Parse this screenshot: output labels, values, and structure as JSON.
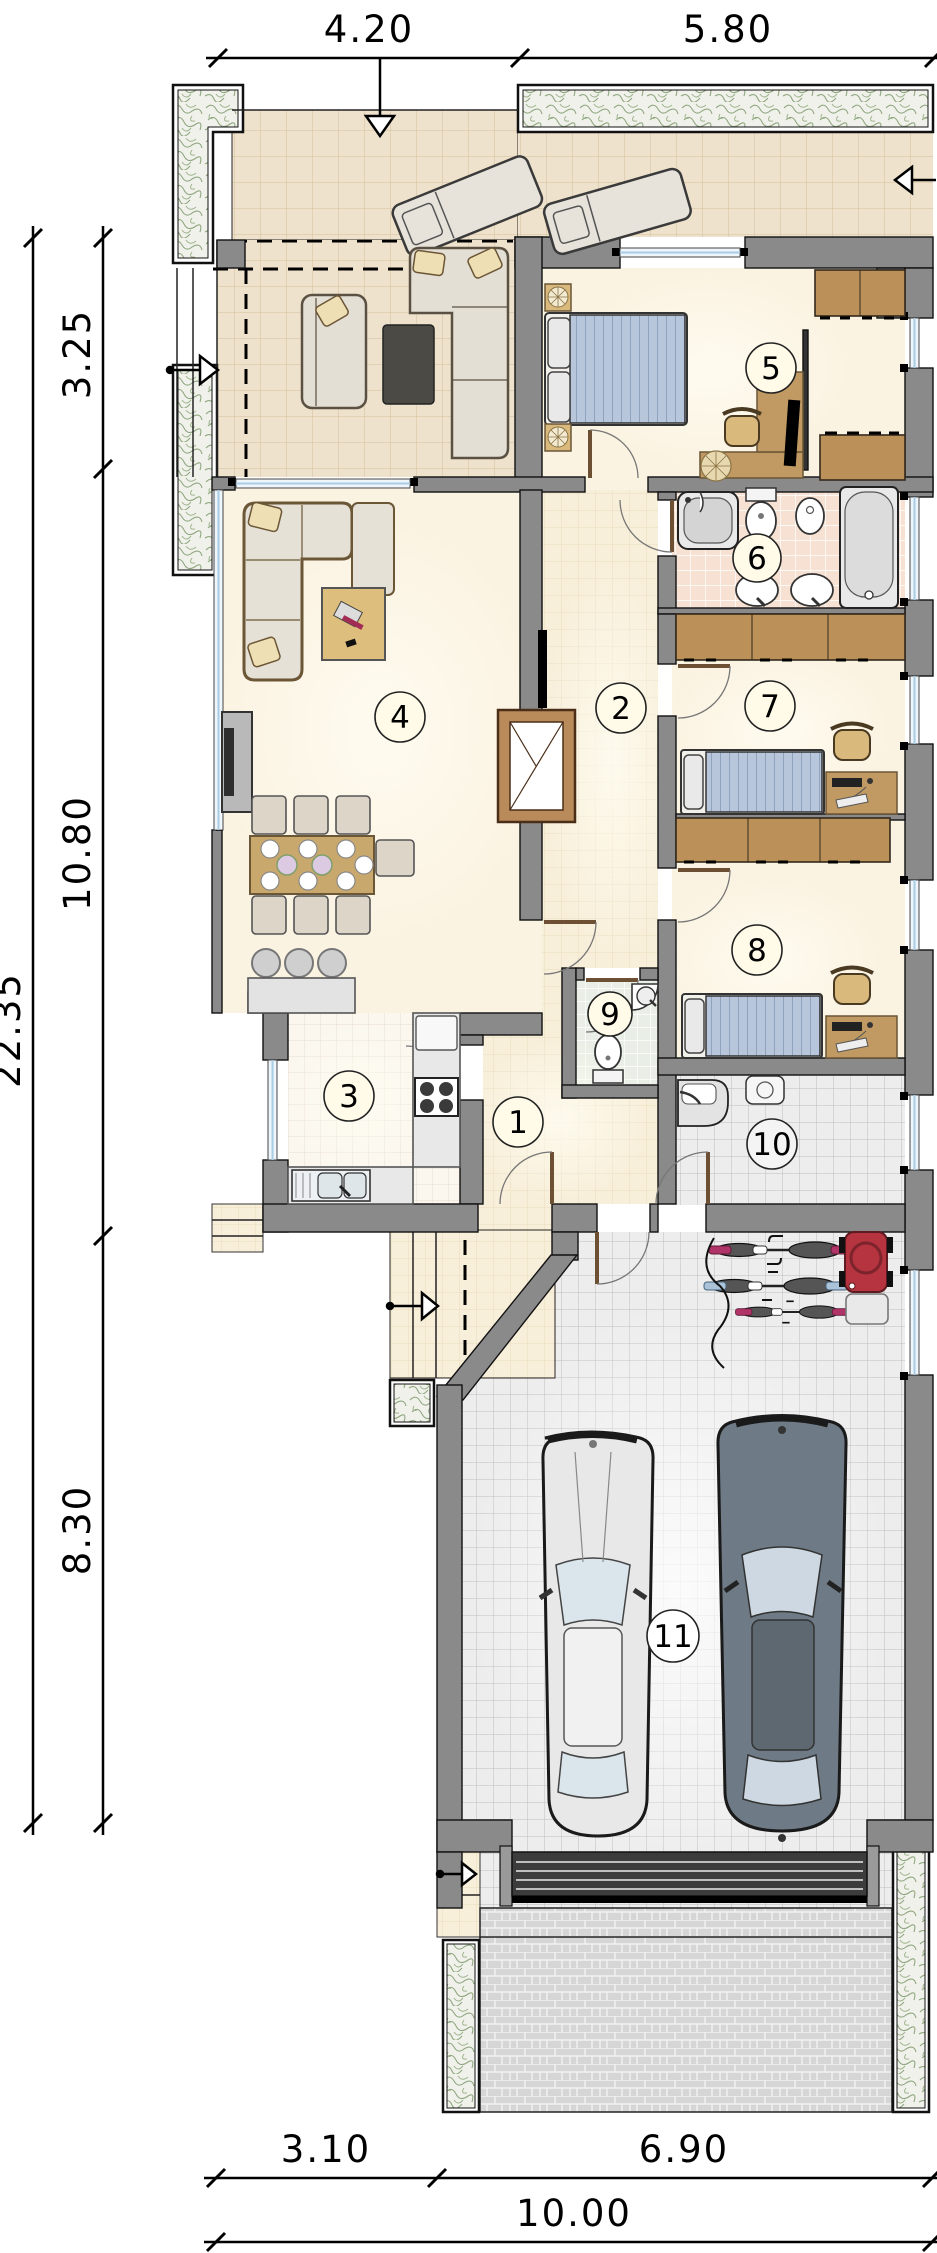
{
  "title": "single-storey house floor plan with garage",
  "dimensions": {
    "top": [
      {
        "label": "4.20"
      },
      {
        "label": "5.80"
      }
    ],
    "left": {
      "total": "22.35",
      "segments": [
        {
          "label": "3.25"
        },
        {
          "label": "10.80"
        },
        {
          "label": "8.30"
        }
      ]
    },
    "bottom": {
      "total": "10.00",
      "segments": [
        {
          "label": "3.10"
        },
        {
          "label": "6.90"
        }
      ]
    }
  },
  "rooms": [
    {
      "number": "1"
    },
    {
      "number": "2"
    },
    {
      "number": "3"
    },
    {
      "number": "4"
    },
    {
      "number": "5"
    },
    {
      "number": "6"
    },
    {
      "number": "7"
    },
    {
      "number": "8"
    },
    {
      "number": "9"
    },
    {
      "number": "10"
    },
    {
      "number": "11"
    }
  ],
  "colors": {
    "wall": "#8a8a8a",
    "floor_cream": "#fbf3e2",
    "terrace_tile": "#efe2cc",
    "hall_tile": "#f8efda",
    "bath_tile": "#f6e1d3",
    "wc_tile": "#e9efe6",
    "utility_tile": "#ededed",
    "wood": "#c09a62",
    "wardrobe_wood": "#bb9159",
    "bed_blue": "#b7c6da",
    "car_light": "#e8e8e8",
    "car_dark": "#6e7a85",
    "mower_red": "#b5343f",
    "bike_magenta": "#b03468",
    "bike_blue": "#aac3d8",
    "greenery": "#8fa77f",
    "window_glass": "#a9cce5"
  }
}
